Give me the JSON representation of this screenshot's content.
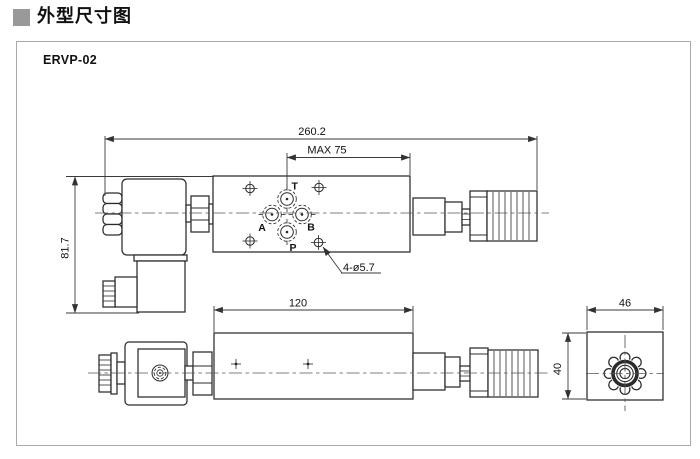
{
  "header": {
    "title": "外型尺寸图"
  },
  "panel": {
    "model": "ERVP-02"
  },
  "drawing": {
    "dims": {
      "overall_length": "260.2",
      "max_adjust": "MAX 75",
      "overall_height": "81.7",
      "mounting_holes": "4-ø5.7",
      "body_length": "120",
      "end_width": "46",
      "end_height": "40"
    },
    "ports": {
      "t": "T",
      "a": "A",
      "b": "B",
      "p": "P"
    }
  },
  "colors": {
    "line": "#2b2b2b",
    "dimension": "#3a3a3a",
    "panel_border": "#a9a9a9",
    "header_square": "#999999",
    "background": "#ffffff"
  }
}
